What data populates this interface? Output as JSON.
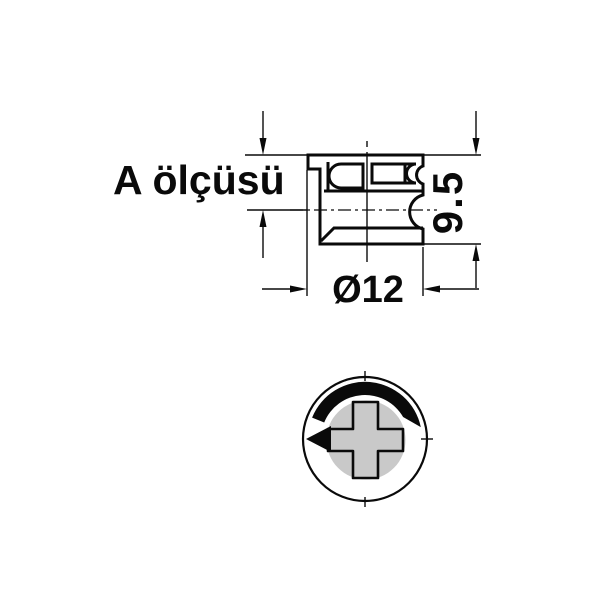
{
  "drawing": {
    "labels": {
      "dimension_a_label": "A ölçüsü",
      "height_value": "9.5",
      "diameter_value": "Ø12"
    },
    "colors": {
      "line": "#0a0a0a",
      "gray_fill": "#c9c9c9",
      "background": "#ffffff"
    },
    "icons": {
      "rotation_arrow": "rotation-direction-arc-arrow",
      "cross_slot": "phillips-cross-slot-icon"
    }
  }
}
